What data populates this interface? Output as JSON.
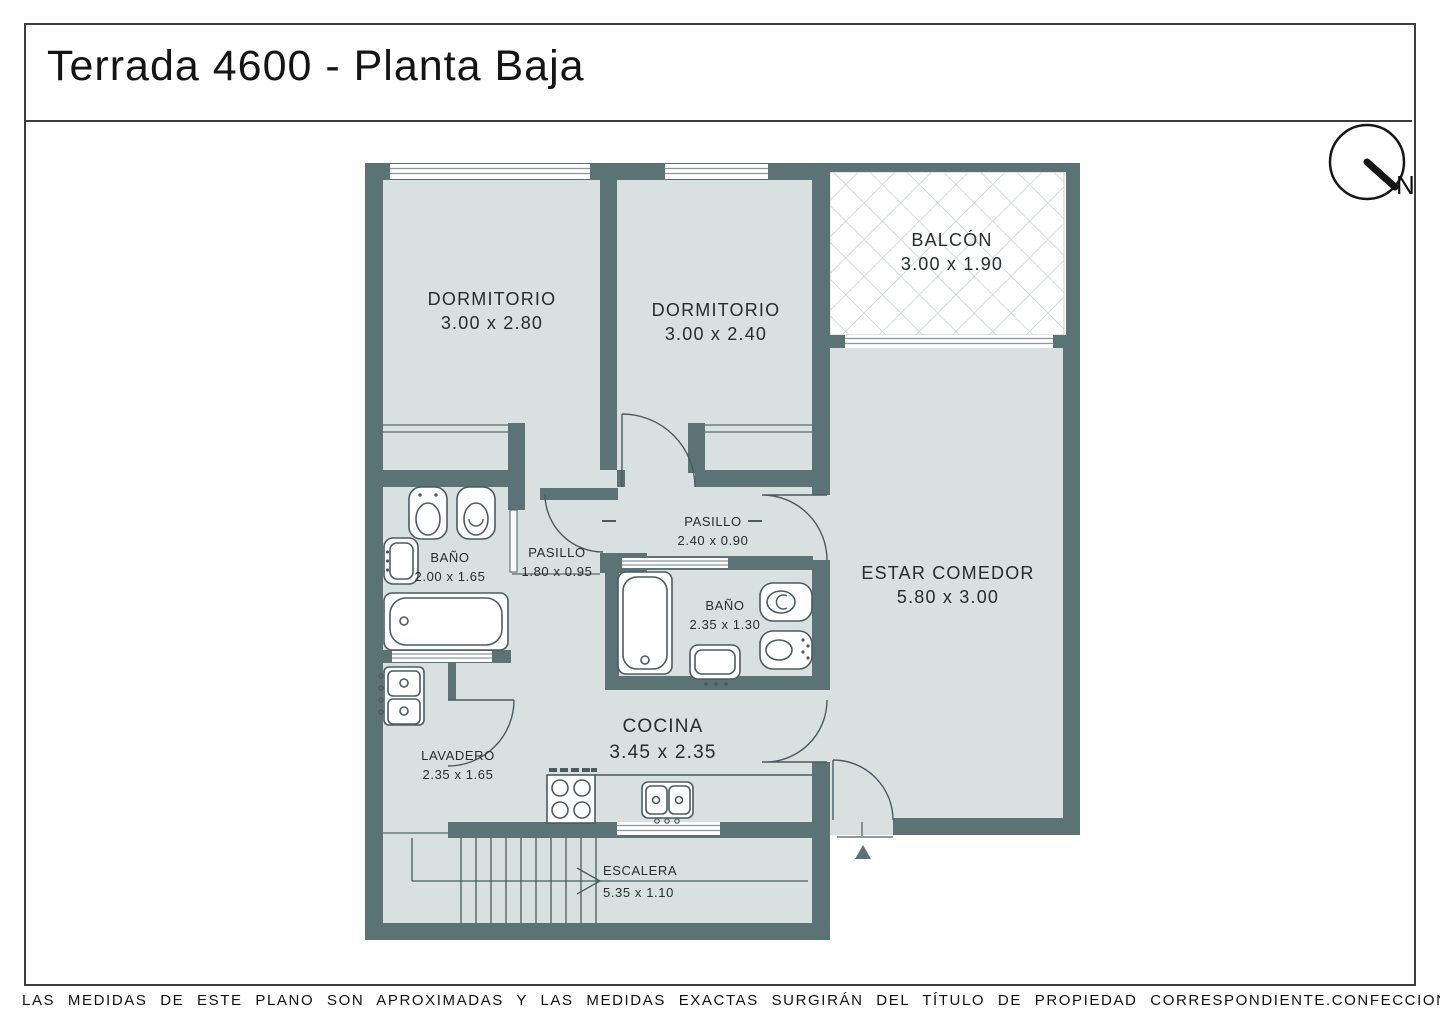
{
  "title": "Terrada 4600 - Planta Baja",
  "compass": {
    "label": "N"
  },
  "rooms": {
    "dormitorio1": {
      "name": "DORMITORIO",
      "dims": "3.00 x 2.80"
    },
    "dormitorio2": {
      "name": "DORMITORIO",
      "dims": "3.00 x 2.40"
    },
    "balcon": {
      "name": "BALCÓN",
      "dims": "3.00 x 1.90"
    },
    "estar_comedor": {
      "name": "ESTAR COMEDOR",
      "dims": "5.80 x 3.00"
    },
    "pasillo_1": {
      "name": "PASILLO",
      "dims": "2.40 x 0.90"
    },
    "pasillo_2": {
      "name": "PASILLO",
      "dims": "1.80 x 0.95"
    },
    "banio_1": {
      "name": "BAÑO",
      "dims": "2.00 x 1.65"
    },
    "banio_2": {
      "name": "BAÑO",
      "dims": "2.35 x 1.30"
    },
    "cocina": {
      "name": "COCINA",
      "dims": "3.45 x 2.35"
    },
    "lavadero": {
      "name": "LAVADERO",
      "dims": "2.35 x 1.65"
    },
    "escalera": {
      "name": "ESCALERA",
      "dims": "5.35 x 1.10"
    }
  },
  "footer": {
    "disclaimer": "LAS MEDIDAS  DE ESTE PLANO SON APROXIMADAS Y LAS MEDIDAS EXACTAS SURGIRÁN DEL TÍTULO DE PROPIEDAD CORRESPONDIENTE.",
    "credit": "CONFECCIONADO POR ESTUDIO NARTEX"
  },
  "colors": {
    "wall": "#5c7376",
    "room_fill": "#d9e0e0",
    "hatch_line": "#c8cfd2",
    "fixture_stroke": "#4a5c60"
  }
}
